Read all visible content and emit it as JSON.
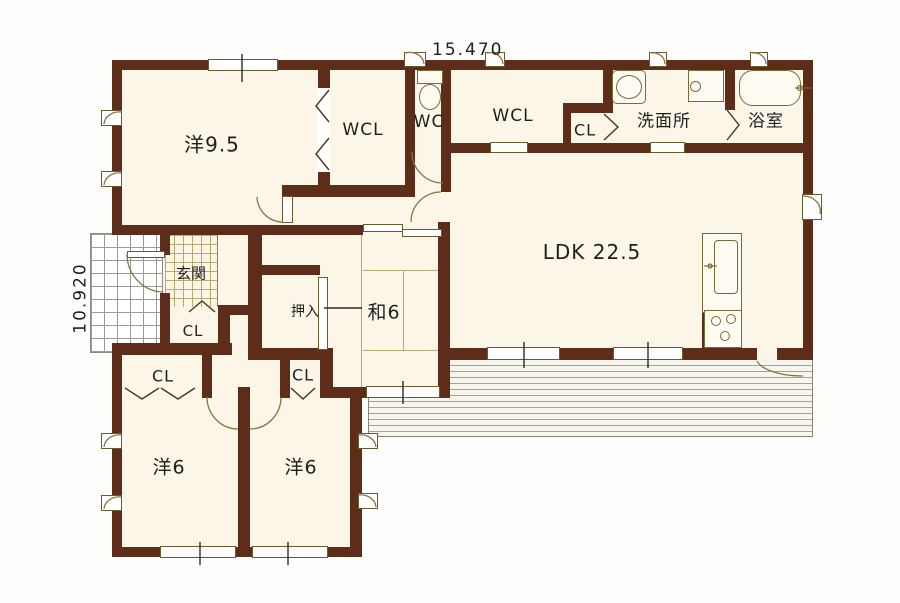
{
  "plan": {
    "title": "floor-plan",
    "dimensions": {
      "width_label": "15.470",
      "height_label": "10.920"
    },
    "rooms": {
      "western95": "洋9.5",
      "wcl_west": "WCL",
      "wc": "WC",
      "wcl_east": "WCL",
      "cl_top": "CL",
      "washroom": "洗面所",
      "bathroom": "浴室",
      "ldk": "LDK 22.5",
      "genkan": "玄関",
      "cl_genkan": "CL",
      "oshiire": "押入",
      "japanese6": "和6",
      "cl_left": "CL",
      "cl_right": "CL",
      "western6_left": "洋6",
      "western6_right": "洋6"
    },
    "colors": {
      "wall": "#5e2d1a",
      "floor": "#fbf6e7",
      "symbol_line": "#8a7340",
      "tatami_line": "#b8a871",
      "text": "#1f1f1f"
    }
  }
}
